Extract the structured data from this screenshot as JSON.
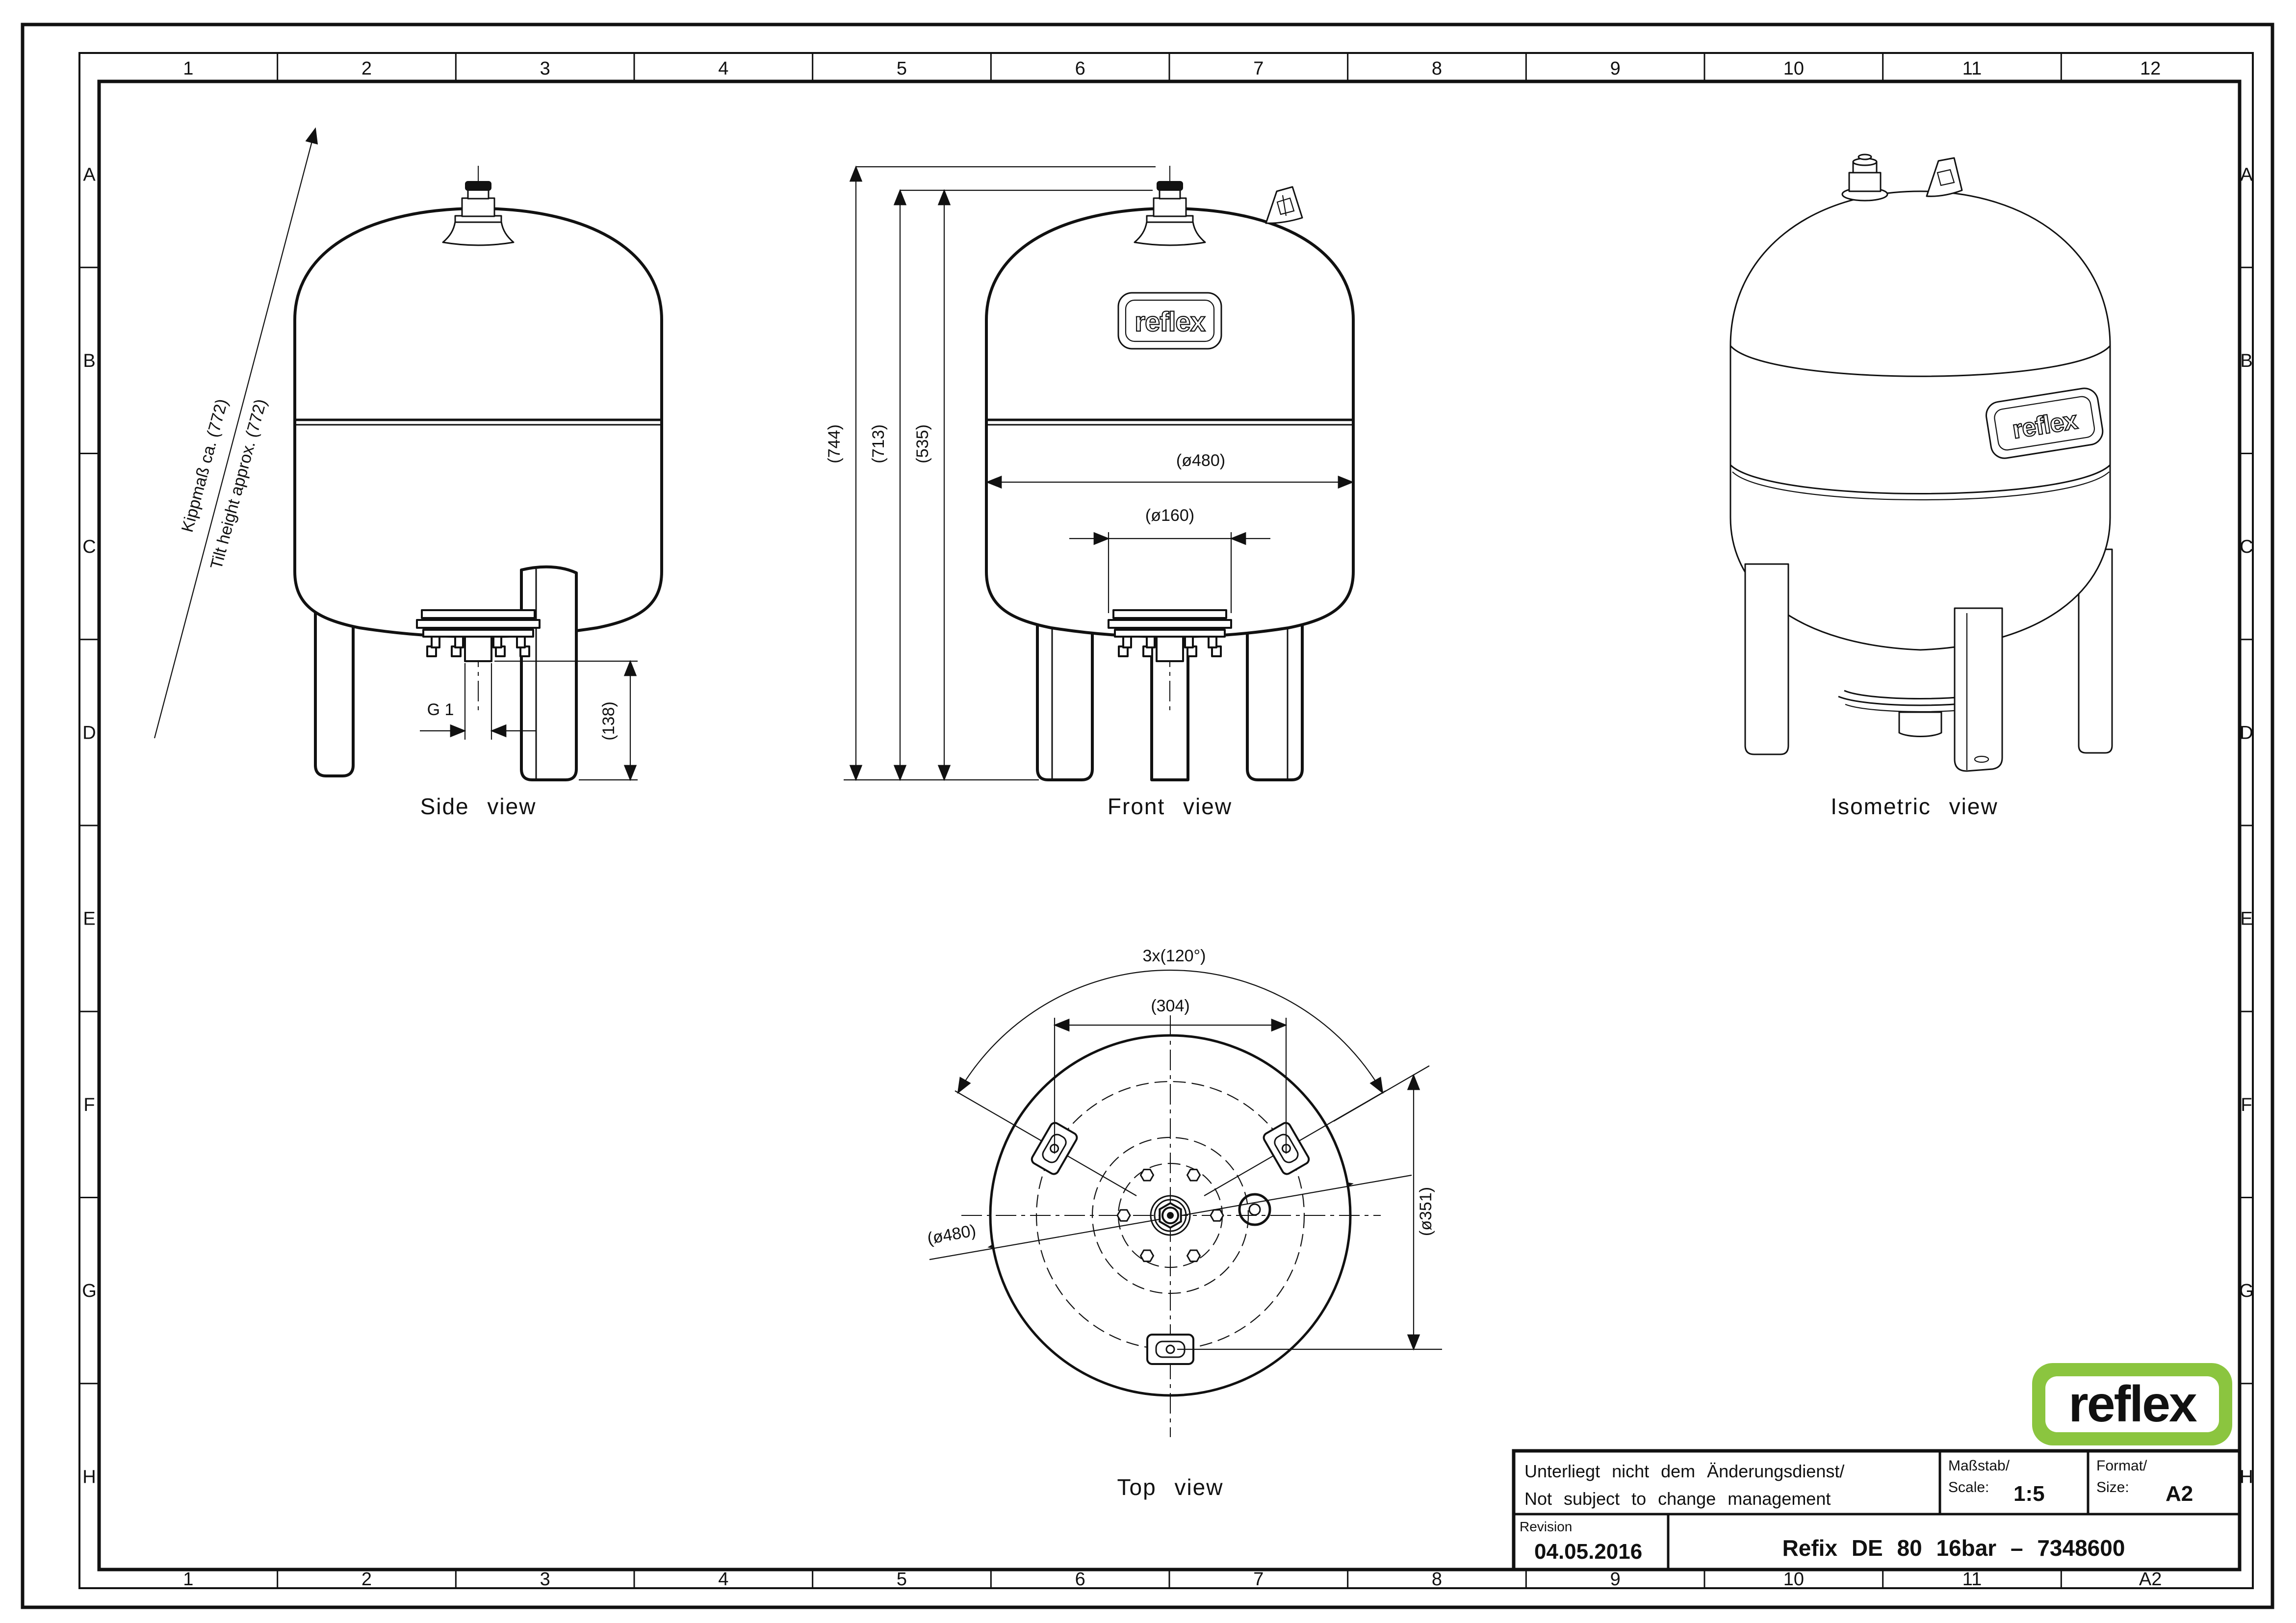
{
  "sheet": {
    "zones_top": [
      "1",
      "2",
      "3",
      "4",
      "5",
      "6",
      "7",
      "8",
      "9",
      "10",
      "11",
      "12"
    ],
    "zones_bottom": [
      "1",
      "2",
      "3",
      "4",
      "5",
      "6",
      "7",
      "8",
      "9",
      "10",
      "11",
      "A2"
    ],
    "rows_left": [
      "A",
      "B",
      "C",
      "D",
      "E",
      "F",
      "G",
      "H"
    ],
    "rows_right": [
      "A",
      "B",
      "C",
      "D",
      "E",
      "F",
      "G",
      "H"
    ]
  },
  "views": {
    "side": {
      "caption": "Side view",
      "tilt_label_de": "Kippmaß ca. (772)",
      "tilt_label_en": "Tilt height approx. (772)",
      "thread_label": "G 1",
      "leg_height": "(138)"
    },
    "front": {
      "caption": "Front view",
      "height_total": "(744)",
      "height_shell": "(713)",
      "height_tangent": "(535)",
      "diameter": "(ø480)",
      "flange_diameter": "(ø160)",
      "vessel_logo": "reflex"
    },
    "isometric": {
      "caption": "Isometric view",
      "vessel_logo": "reflex"
    },
    "top": {
      "caption": "Top view",
      "feet_pitch": "3x(120°)",
      "feet_spacing": "(304)",
      "diameter": "(ø480)",
      "foot_circle": "(ø351)"
    }
  },
  "title_block": {
    "note_line1": "Unterliegt nicht dem Änderungsdienst/",
    "note_line2": "Not subject to change management",
    "scale_label_de": "Maßstab/",
    "scale_label_en": "Scale:",
    "scale_value": "1:5",
    "format_label_de": "Format/",
    "format_label_en": "Size:",
    "format_value": "A2",
    "revision_label": "Revision",
    "revision_date": "04.05.2016",
    "drawing_title": "Refix DE 80 16bar – 7348600"
  },
  "logo": {
    "text": "reflex",
    "color_green": "#8bc53f"
  }
}
